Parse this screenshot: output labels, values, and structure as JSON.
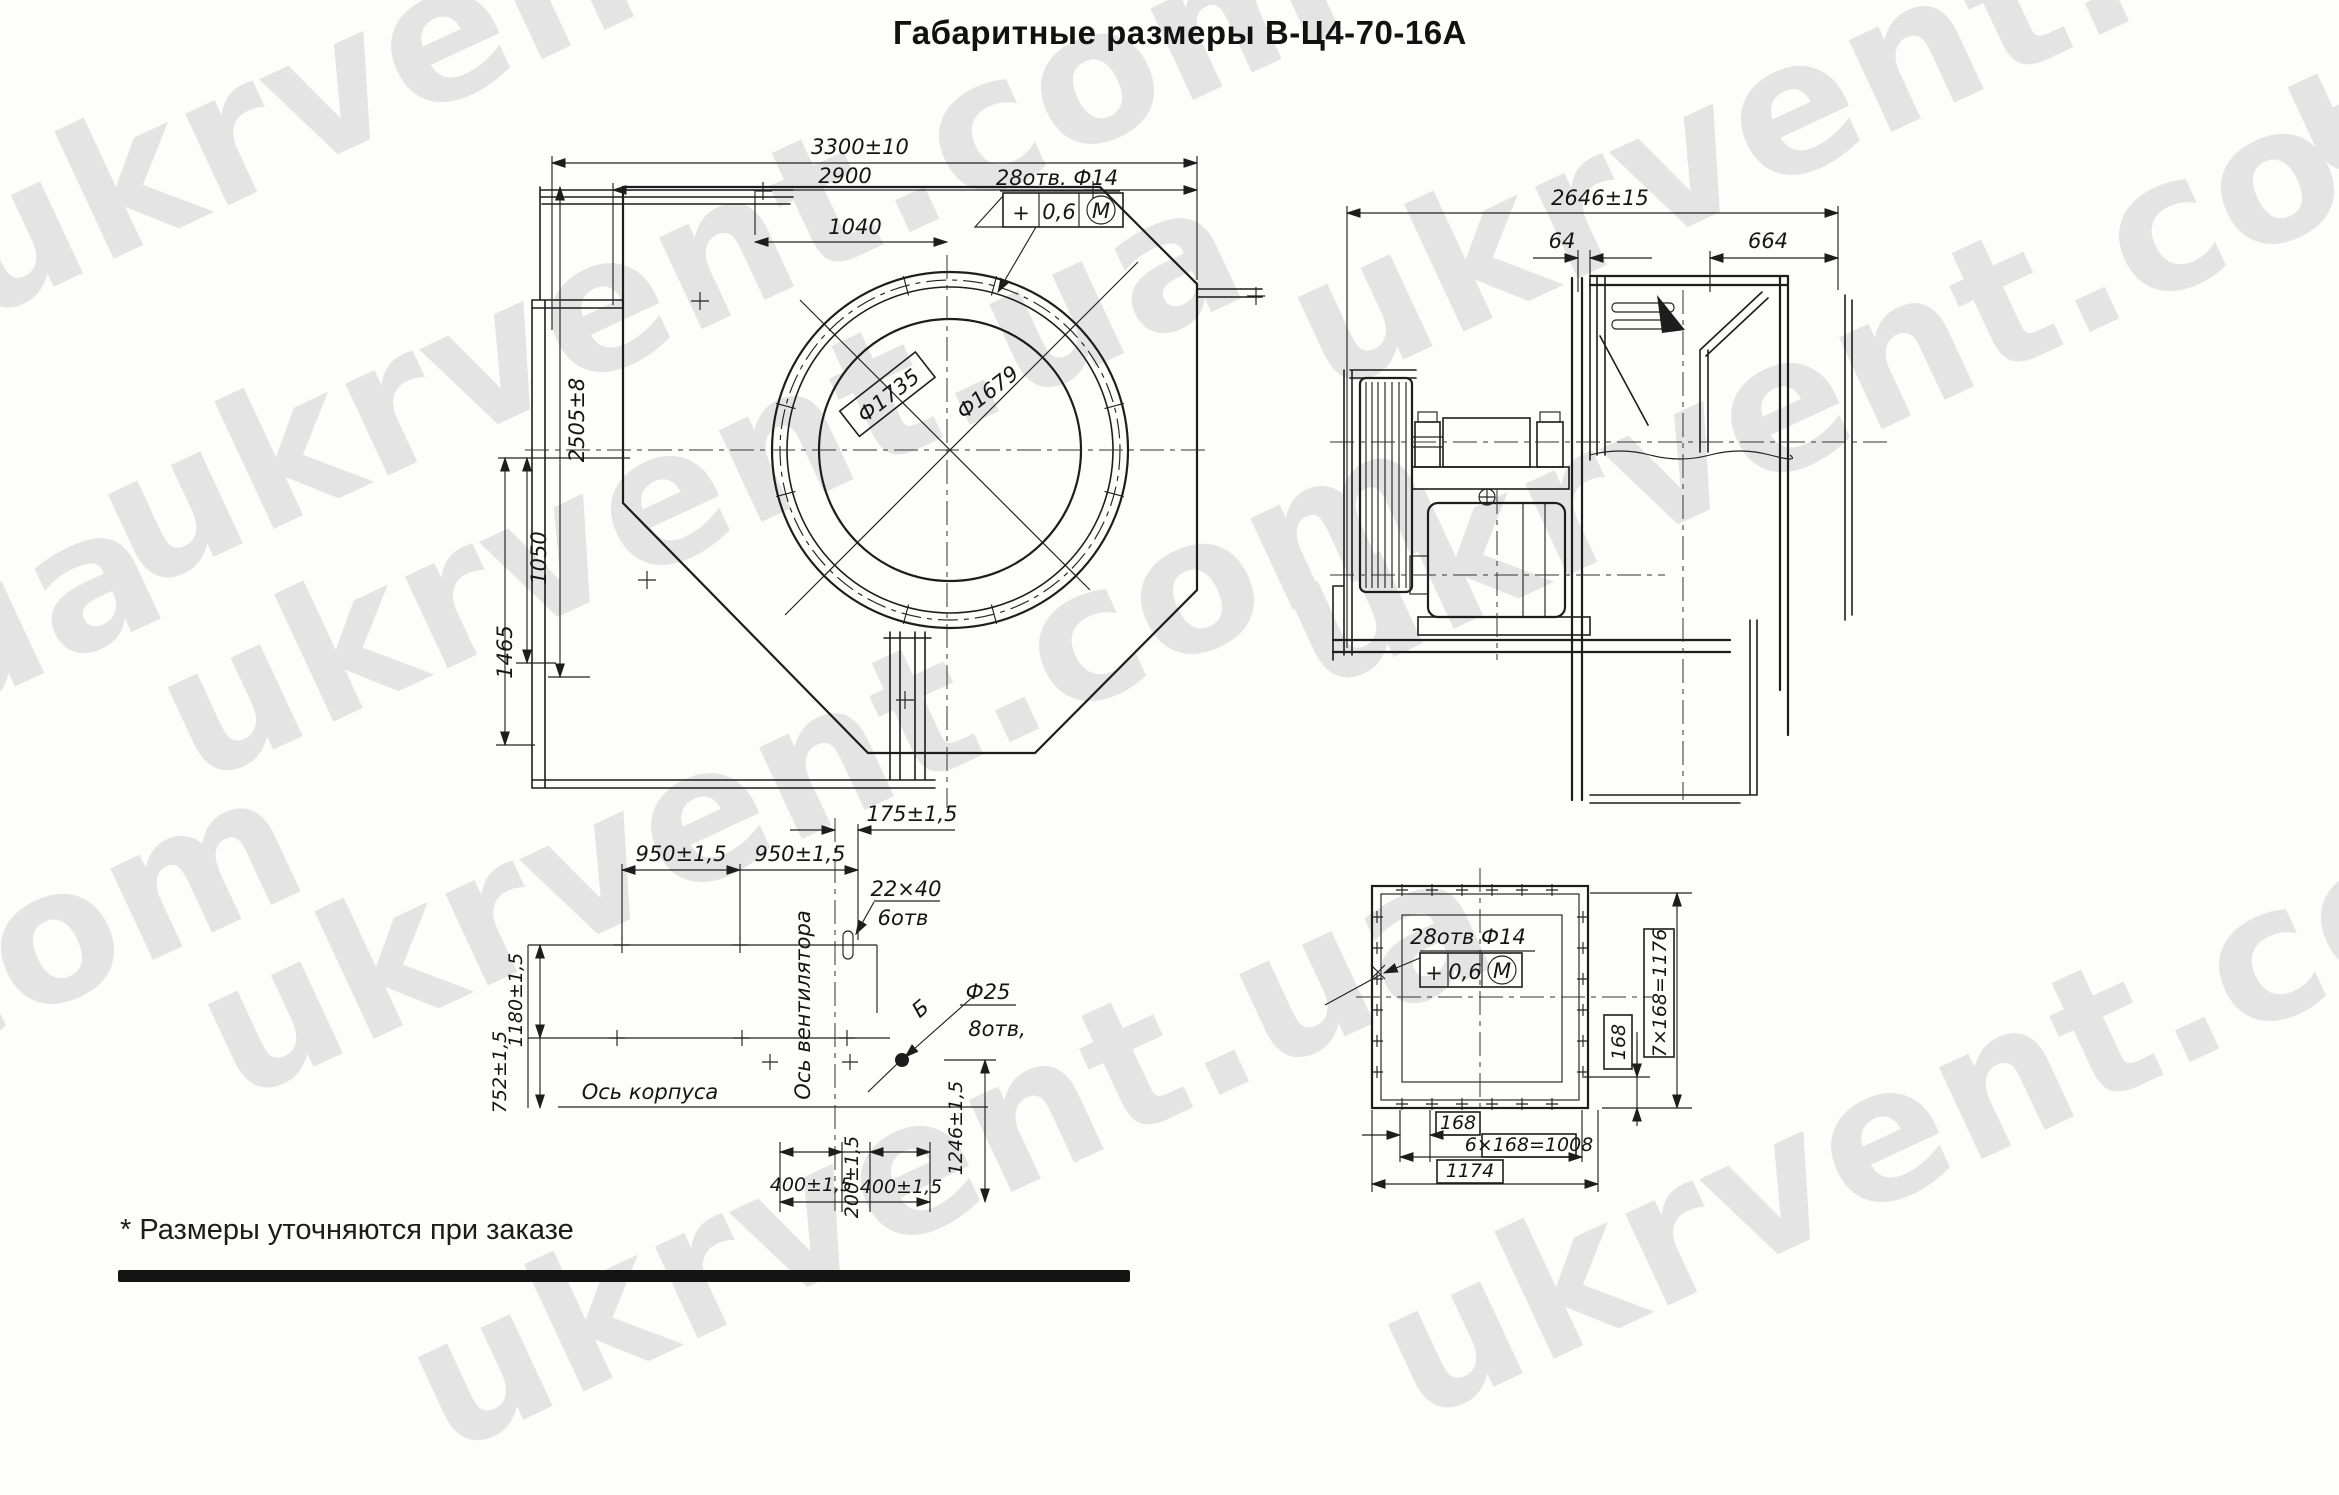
{
  "title": "Габаритные размеры В-Ц4-70-16А",
  "footnote": "* Размеры уточняются при заказе",
  "watermark": {
    "com": "ukrvent.com",
    "ua": "ukrvent.ua",
    "color": "#e4e4e4"
  },
  "line_color": "#1d1d1d",
  "front": {
    "dim_3300": "3300±10",
    "dim_2900": "2900",
    "dim_1040": "1040",
    "holes": "28отв. Ф14",
    "tol_plus": "+",
    "tol_val": "0,6",
    "tol_mod": "М",
    "bolt_circle": "Ф1735",
    "inlet": "Ф1679",
    "dim_2505": "2505±8",
    "dim_1050": "1050",
    "dim_1465": "1465"
  },
  "side": {
    "dim_2646": "2646±15",
    "dim_64": "64",
    "dim_664": "664"
  },
  "plan": {
    "dim_175": "175±1,5",
    "dim_950a": "950±1,5",
    "dim_950b": "950±1,5",
    "slot_size": "22×40",
    "slot_count": "6отв",
    "hole_dia": "Ф25",
    "hole_count": "8отв,",
    "view_label": "Б",
    "axis_fan": "Ось вентилятора",
    "axis_body": "Ось корпуса",
    "dim_1180": "1180±1,5",
    "dim_752": "752±1,5",
    "dim_1246": "1246±1,5",
    "dim_400a": "400±1,5",
    "dim_200": "200±1,5",
    "dim_400b": "400±1,5"
  },
  "flange": {
    "holes": "28отв Ф14",
    "tol_plus": "+",
    "tol_val": "0,6",
    "tol_mod": "М",
    "v_total": "7×168=1176",
    "v_pitch": "168",
    "h_pitch_one": "168",
    "h_pitch_all": "6×168=1008",
    "h_total": "1174"
  }
}
